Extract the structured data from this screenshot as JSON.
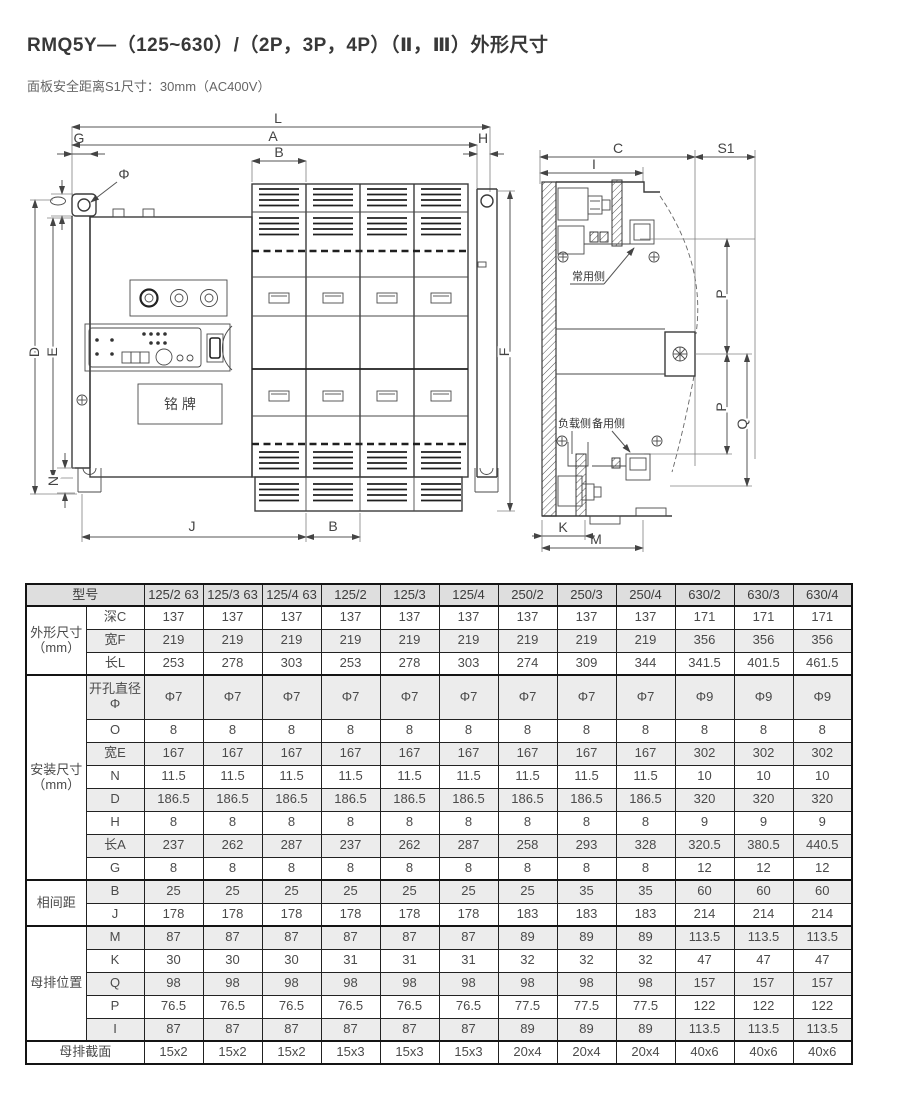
{
  "page": {
    "title": "RMQ5Y—（125~630）/（2P，3P，4P）（Ⅱ，Ⅲ）外形尺寸",
    "subtitle": "面板安全距离S1尺寸：30mm（AC400V）"
  },
  "colors": {
    "table_header_bg": "#dedede",
    "row_shade_bg": "#ececec",
    "table_border": "#141414",
    "text": "#4a4a4a"
  },
  "front_view": {
    "dim_L": "L",
    "dim_A": "A",
    "dim_B_top": "B",
    "dim_G": "G",
    "dim_H": "H",
    "dim_phi": "Φ",
    "dim_D": "D",
    "dim_E": "E",
    "dim_F": "F",
    "dim_N": "N",
    "dim_J": "J",
    "dim_B_bottom": "B",
    "nameplate": "铭 牌"
  },
  "side_view": {
    "dim_C": "C",
    "dim_S1": "S1",
    "dim_I": "I",
    "dim_P_upper": "P",
    "dim_P_lower": "P",
    "dim_Q": "Q",
    "dim_K": "K",
    "dim_M": "M",
    "label_normal_side": "常用侧",
    "label_load_side": "负载侧",
    "label_backup_side": "备用侧"
  },
  "table": {
    "model_header": "型号",
    "models": [
      "125/2 63",
      "125/3 63",
      "125/4 63",
      "125/2",
      "125/3",
      "125/4",
      "250/2",
      "250/3",
      "250/4",
      "630/2",
      "630/3",
      "630/4"
    ],
    "sections": [
      {
        "label": "外形尺寸（mm）",
        "rows": [
          {
            "name": "深C",
            "values": [
              "137",
              "137",
              "137",
              "137",
              "137",
              "137",
              "137",
              "137",
              "137",
              "171",
              "171",
              "171"
            ]
          },
          {
            "name": "宽F",
            "values": [
              "219",
              "219",
              "219",
              "219",
              "219",
              "219",
              "219",
              "219",
              "219",
              "356",
              "356",
              "356"
            ]
          },
          {
            "name": "长L",
            "values": [
              "253",
              "278",
              "303",
              "253",
              "278",
              "303",
              "274",
              "309",
              "344",
              "341.5",
              "401.5",
              "461.5"
            ]
          }
        ]
      },
      {
        "label": "安装尺寸（mm）",
        "rows": [
          {
            "name": "开孔直径Φ",
            "values": [
              "Φ7",
              "Φ7",
              "Φ7",
              "Φ7",
              "Φ7",
              "Φ7",
              "Φ7",
              "Φ7",
              "Φ7",
              "Φ9",
              "Φ9",
              "Φ9"
            ]
          },
          {
            "name": "O",
            "values": [
              "8",
              "8",
              "8",
              "8",
              "8",
              "8",
              "8",
              "8",
              "8",
              "8",
              "8",
              "8"
            ]
          },
          {
            "name": "宽E",
            "values": [
              "167",
              "167",
              "167",
              "167",
              "167",
              "167",
              "167",
              "167",
              "167",
              "302",
              "302",
              "302"
            ]
          },
          {
            "name": "N",
            "values": [
              "11.5",
              "11.5",
              "11.5",
              "11.5",
              "11.5",
              "11.5",
              "11.5",
              "11.5",
              "11.5",
              "10",
              "10",
              "10"
            ]
          },
          {
            "name": "D",
            "values": [
              "186.5",
              "186.5",
              "186.5",
              "186.5",
              "186.5",
              "186.5",
              "186.5",
              "186.5",
              "186.5",
              "320",
              "320",
              "320"
            ]
          },
          {
            "name": "H",
            "values": [
              "8",
              "8",
              "8",
              "8",
              "8",
              "8",
              "8",
              "8",
              "8",
              "9",
              "9",
              "9"
            ]
          },
          {
            "name": "长A",
            "values": [
              "237",
              "262",
              "287",
              "237",
              "262",
              "287",
              "258",
              "293",
              "328",
              "320.5",
              "380.5",
              "440.5"
            ]
          },
          {
            "name": "G",
            "values": [
              "8",
              "8",
              "8",
              "8",
              "8",
              "8",
              "8",
              "8",
              "8",
              "12",
              "12",
              "12"
            ]
          }
        ]
      },
      {
        "label": "相间距",
        "rows": [
          {
            "name": "B",
            "values": [
              "25",
              "25",
              "25",
              "25",
              "25",
              "25",
              "25",
              "35",
              "35",
              "60",
              "60",
              "60"
            ]
          },
          {
            "name": "J",
            "values": [
              "178",
              "178",
              "178",
              "178",
              "178",
              "178",
              "183",
              "183",
              "183",
              "214",
              "214",
              "214"
            ]
          }
        ]
      },
      {
        "label": "母排位置",
        "rows": [
          {
            "name": "M",
            "values": [
              "87",
              "87",
              "87",
              "87",
              "87",
              "87",
              "89",
              "89",
              "89",
              "113.5",
              "113.5",
              "113.5"
            ]
          },
          {
            "name": "K",
            "values": [
              "30",
              "30",
              "30",
              "31",
              "31",
              "31",
              "32",
              "32",
              "32",
              "47",
              "47",
              "47"
            ]
          },
          {
            "name": "Q",
            "values": [
              "98",
              "98",
              "98",
              "98",
              "98",
              "98",
              "98",
              "98",
              "98",
              "157",
              "157",
              "157"
            ]
          },
          {
            "name": "P",
            "values": [
              "76.5",
              "76.5",
              "76.5",
              "76.5",
              "76.5",
              "76.5",
              "77.5",
              "77.5",
              "77.5",
              "122",
              "122",
              "122"
            ]
          },
          {
            "name": "I",
            "values": [
              "87",
              "87",
              "87",
              "87",
              "87",
              "87",
              "89",
              "89",
              "89",
              "113.5",
              "113.5",
              "113.5"
            ]
          }
        ]
      }
    ],
    "footer_row": {
      "label": "母排截面",
      "values": [
        "15x2",
        "15x2",
        "15x2",
        "15x3",
        "15x3",
        "15x3",
        "20x4",
        "20x4",
        "20x4",
        "40x6",
        "40x6",
        "40x6"
      ]
    }
  }
}
